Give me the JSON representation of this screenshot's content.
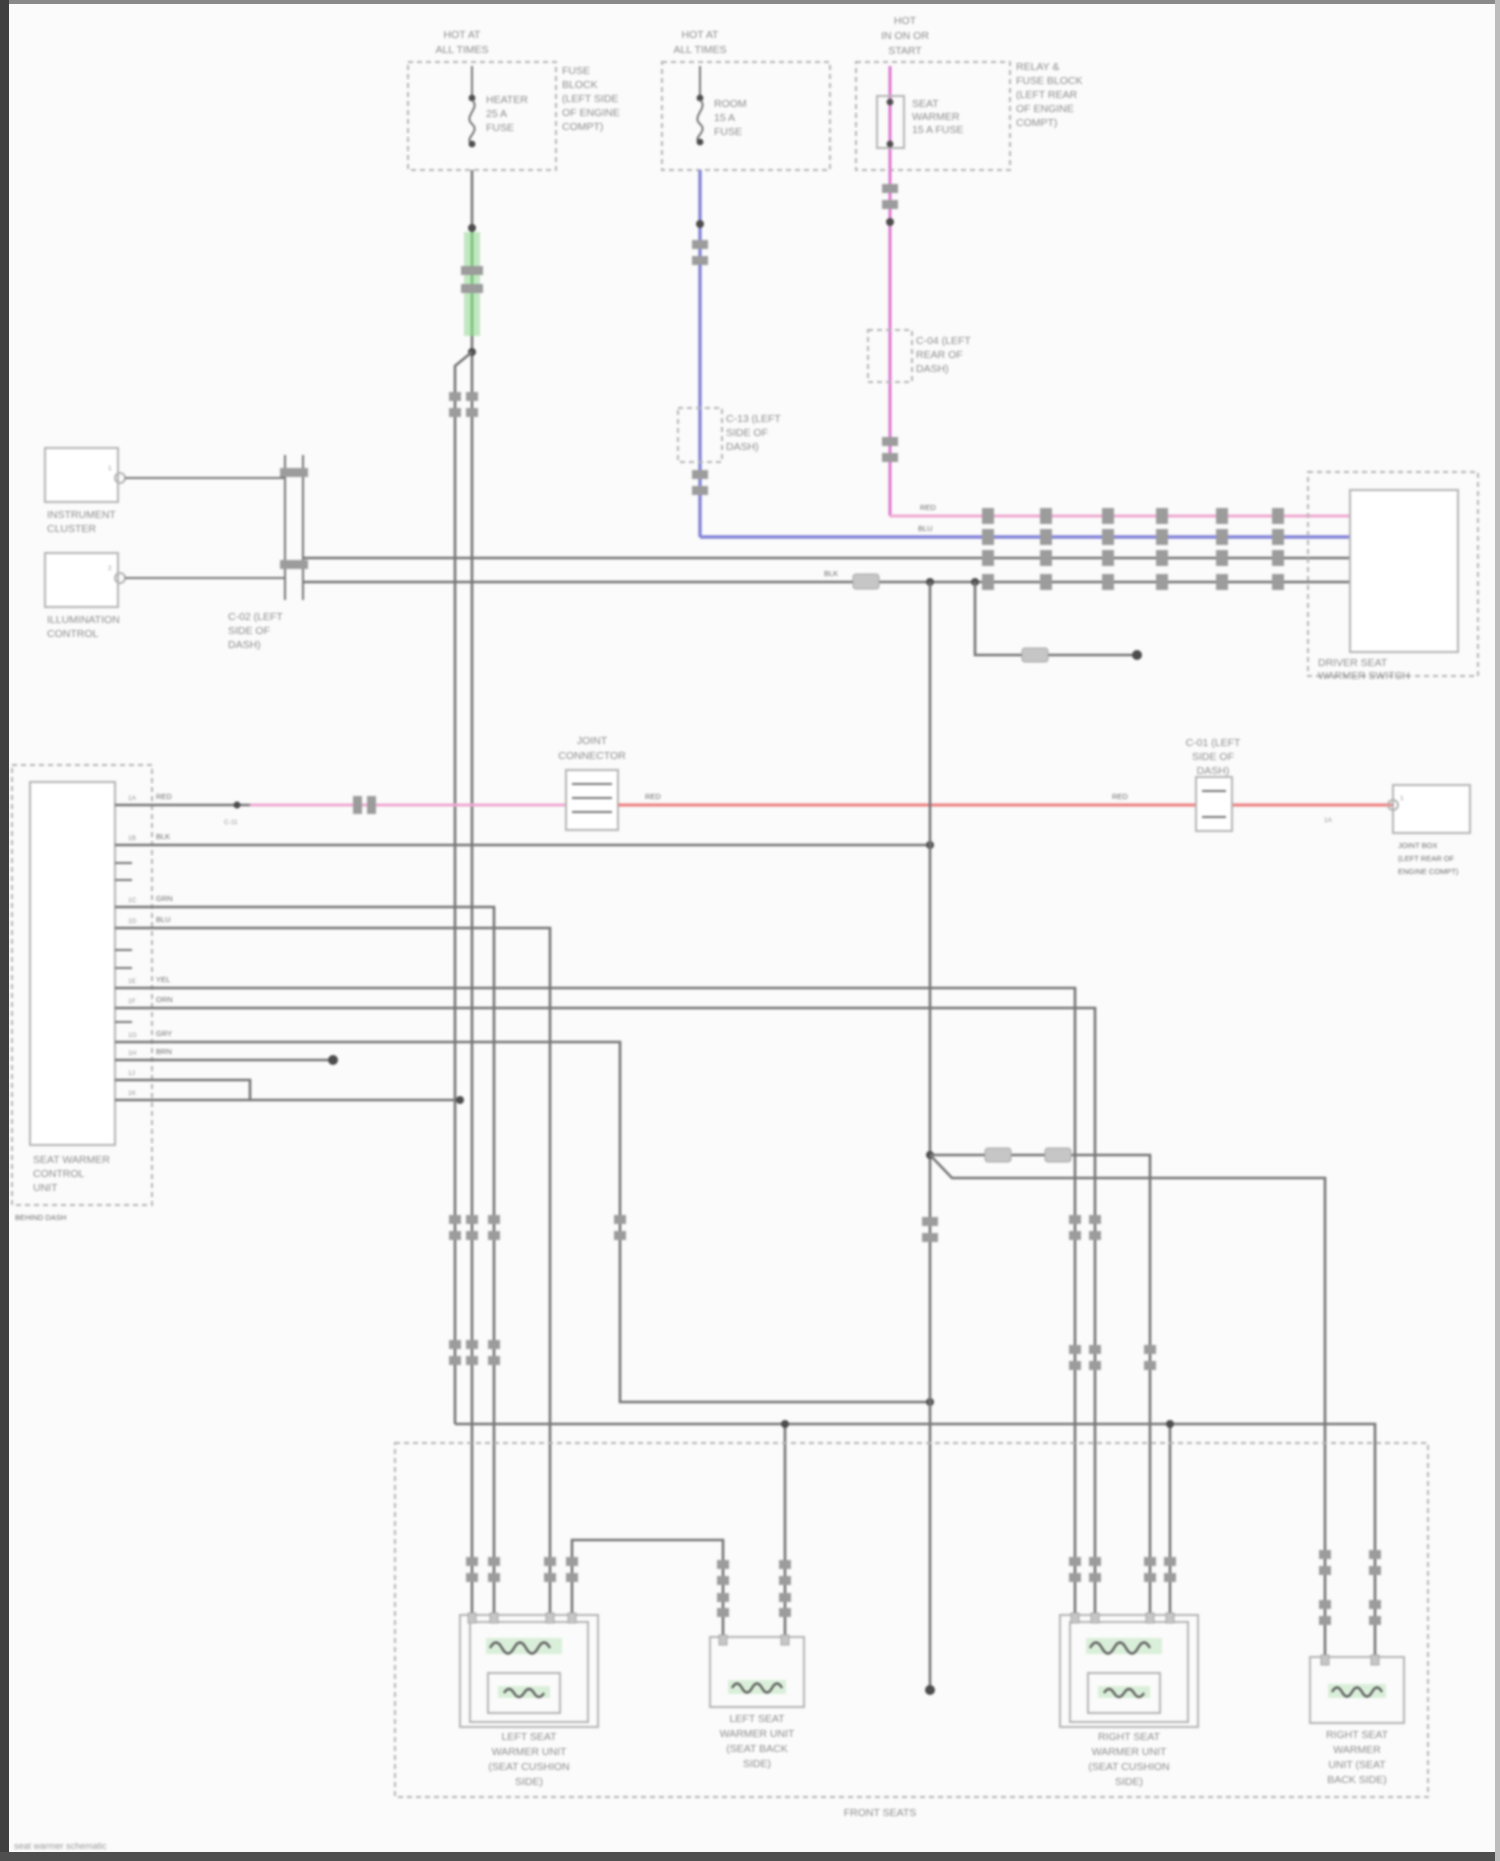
{
  "colors": {
    "wire": "#767676",
    "tick": "#9c9c9c",
    "box": "#b3b3b3",
    "text": "#8d8d8d",
    "green": "#7ec77e",
    "green_band": "#c2e7c2",
    "blue": "#8484d8",
    "magenta": "#df7ed2",
    "pink": "#efa8cf",
    "red": "#ee8585"
  },
  "fuses": {
    "a": {
      "above": [
        "HOT AT",
        "ALL TIMES"
      ],
      "inside": [
        "HEATER",
        "25 A",
        "FUSE"
      ],
      "right": [
        "FUSE",
        "BLOCK",
        "(LEFT SIDE",
        "OF ENGINE",
        "COMPT)"
      ]
    },
    "b": {
      "above": [
        "HOT AT",
        "ALL TIMES"
      ],
      "inside": [
        "ROOM",
        "15 A",
        "FUSE"
      ]
    },
    "c": {
      "above": [
        "HOT",
        "IN ON OR",
        "START"
      ],
      "inside": [
        "SEAT",
        "WARMER",
        "15 A FUSE"
      ],
      "right": [
        "RELAY &",
        "FUSE BLOCK",
        "(LEFT REAR",
        "OF ENGINE",
        "COMPT)"
      ]
    }
  },
  "connectors": {
    "blue_inline": [
      "C-13 (LEFT",
      "SIDE OF",
      "DASH)"
    ],
    "pink_inline": [
      "C-04 (LEFT",
      "REAR OF",
      "DASH)"
    ],
    "joint_left": [
      "C-02 (LEFT",
      "SIDE OF",
      "DASH)"
    ],
    "red_joint": [
      "JOINT",
      "CONNECTOR"
    ],
    "red_mid": [
      "C-01 (LEFT",
      "SIDE OF",
      "DASH)"
    ],
    "red_small": "C-11",
    "end_box": [
      "JOINT BOX",
      "(LEFT REAR OF",
      "ENGINE COMPT)"
    ],
    "end_pin": "1"
  },
  "left_units": {
    "box1": {
      "label": [
        "INSTRUMENT",
        "CLUSTER"
      ],
      "pin": "1"
    },
    "box2": {
      "label": [
        "ILLUMINATION",
        "CONTROL"
      ],
      "pin": "2"
    }
  },
  "module": {
    "label": [
      "SEAT WARMER",
      "CONTROL",
      "UNIT"
    ],
    "sub": "BEHIND DASH",
    "pins": [
      "1A",
      "1B",
      "1C",
      "1D",
      "1E",
      "1F",
      "1G",
      "1H",
      "1J",
      "1K"
    ],
    "wire_tags": [
      "RED",
      "BLK",
      "GRN",
      "BLU",
      "YEL",
      "ORN",
      "GRY",
      "BRN"
    ]
  },
  "switch": {
    "label": [
      "DRIVER SEAT",
      "WARMER SWITCH"
    ]
  },
  "wire_tags": {
    "pink_row": "RED",
    "blue_row": "BLU",
    "h0": "BLK",
    "red1": "RED",
    "red2": "RED",
    "red3": "1A"
  },
  "seats": {
    "label": "FRONT SEATS",
    "unit_a": [
      "LEFT SEAT",
      "WARMER UNIT",
      "(SEAT CUSHION",
      "SIDE)"
    ],
    "unit_b": [
      "LEFT SEAT",
      "WARMER UNIT",
      "(SEAT BACK",
      "SIDE)"
    ],
    "unit_c": [
      "RIGHT SEAT",
      "WARMER UNIT",
      "(SEAT CUSHION",
      "SIDE)"
    ],
    "unit_d": [
      "RIGHT SEAT",
      "WARMER",
      "UNIT (SEAT",
      "BACK SIDE)"
    ]
  },
  "footer": "seat warmer schematic"
}
